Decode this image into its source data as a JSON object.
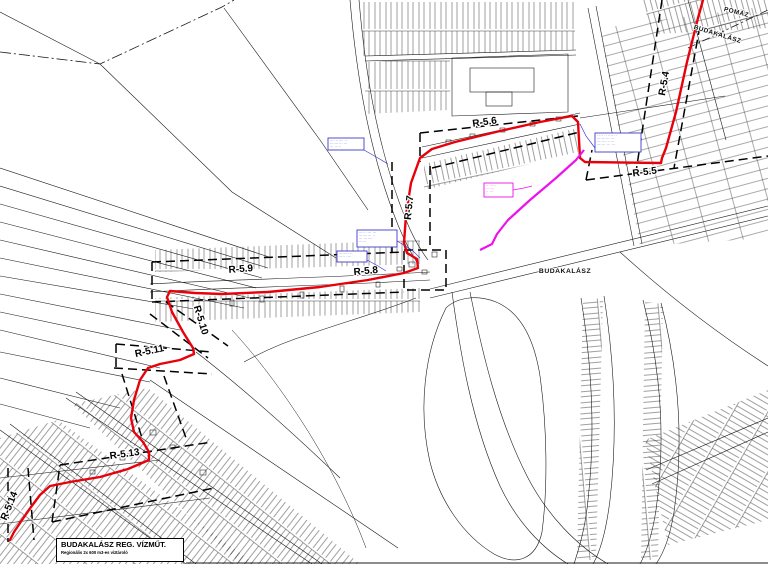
{
  "map": {
    "colors": {
      "route": "#e8000a",
      "magenta": "#ec12ec",
      "callout_blue": "#3c3ccc",
      "ink": "#000000"
    },
    "place_labels": [
      {
        "text": "POMÁZ",
        "x": 736,
        "y": 14,
        "rot": 14,
        "size": 6.4
      },
      {
        "text": "BUDAKALÁSZ",
        "x": 717,
        "y": 36,
        "rot": 17,
        "size": 6.4
      },
      {
        "text": "BUDAKALÁSZ",
        "x": 565,
        "y": 273,
        "rot": 0,
        "size": 6.8
      }
    ],
    "sheet_labels": [
      {
        "text": "R-5.4",
        "x": 667,
        "y": 84,
        "rot": -80
      },
      {
        "text": "R-5.5",
        "x": 645,
        "y": 175,
        "rot": -7
      },
      {
        "text": "R-5.6",
        "x": 485,
        "y": 125,
        "rot": -8
      },
      {
        "text": "R-5.7",
        "x": 412,
        "y": 208,
        "rot": -84
      },
      {
        "text": "R-5.8",
        "x": 366,
        "y": 274,
        "rot": -5
      },
      {
        "text": "R-5.9",
        "x": 241,
        "y": 272,
        "rot": -4
      },
      {
        "text": "R-5.10",
        "x": 198,
        "y": 321,
        "rot": 73
      },
      {
        "text": "R-5.11",
        "x": 150,
        "y": 354,
        "rot": -12
      },
      {
        "text": "R-5.13",
        "x": 125,
        "y": 457,
        "rot": -8
      },
      {
        "text": "R-5.14",
        "x": 12,
        "y": 507,
        "rot": -68
      }
    ],
    "routes": {
      "red_main": [
        [
          703,
          0
        ],
        [
          698,
          18
        ],
        [
          687,
          62
        ],
        [
          676,
          112
        ],
        [
          666,
          148
        ],
        [
          662,
          158
        ],
        [
          661,
          163
        ],
        [
          585,
          162
        ],
        [
          580,
          158
        ],
        [
          578,
          122
        ],
        [
          572,
          116
        ],
        [
          540,
          122
        ],
        [
          500,
          131
        ],
        [
          455,
          142
        ],
        [
          432,
          149
        ],
        [
          420,
          158
        ],
        [
          411,
          183
        ],
        [
          406,
          215
        ],
        [
          404,
          243
        ],
        [
          407,
          253
        ],
        [
          417,
          259
        ],
        [
          418,
          268
        ],
        [
          404,
          273
        ],
        [
          368,
          280
        ],
        [
          320,
          287
        ],
        [
          268,
          292
        ],
        [
          222,
          294
        ],
        [
          195,
          293
        ],
        [
          170,
          291
        ],
        [
          167,
          297
        ],
        [
          172,
          312
        ],
        [
          183,
          332
        ],
        [
          193,
          348
        ],
        [
          194,
          354
        ],
        [
          180,
          360
        ],
        [
          160,
          364
        ],
        [
          148,
          368
        ],
        [
          140,
          380
        ],
        [
          134,
          400
        ],
        [
          131,
          418
        ],
        [
          134,
          432
        ],
        [
          143,
          442
        ],
        [
          149,
          452
        ],
        [
          149,
          460
        ],
        [
          128,
          469
        ],
        [
          100,
          477
        ],
        [
          70,
          482
        ],
        [
          50,
          486
        ],
        [
          40,
          495
        ],
        [
          31,
          507
        ],
        [
          22,
          520
        ],
        [
          14,
          532
        ],
        [
          10,
          540
        ]
      ],
      "magenta": [
        [
          584,
          150
        ],
        [
          576,
          160
        ],
        [
          556,
          178
        ],
        [
          530,
          200
        ],
        [
          508,
          220
        ],
        [
          497,
          234
        ],
        [
          492,
          244
        ],
        [
          480,
          250
        ]
      ]
    },
    "callouts": {
      "blue": [
        {
          "x": 328,
          "y": 138,
          "w": 36,
          "h": 12,
          "lines": [
            "···· ······ ··",
            "········· ····",
            "··· ·····"
          ],
          "leader": [
            [
              364,
              150
            ],
            [
              378,
              158
            ],
            [
              388,
              164
            ]
          ]
        },
        {
          "x": 357,
          "y": 230,
          "w": 40,
          "h": 17,
          "lines": [
            "····· ···· ···",
            "·········· ··",
            "··· ·······",
            "······"
          ],
          "leader": [
            [
              397,
              241
            ],
            [
              412,
              250
            ],
            [
              420,
              258
            ]
          ]
        },
        {
          "x": 337,
          "y": 251,
          "w": 30,
          "h": 11,
          "lines": [
            "········ ··",
            "····· ····"
          ],
          "leader": [
            [
              367,
              260
            ],
            [
              378,
              266
            ],
            [
              386,
              271
            ]
          ]
        },
        {
          "x": 595,
          "y": 133,
          "w": 46,
          "h": 19,
          "lines": [
            "· ··· ·· ···· ··",
            "·········· ···",
            "········ ·····",
            "······· ··· ···"
          ],
          "leader": [
            [
              595,
              148
            ],
            [
              586,
              136
            ],
            [
              580,
              124
            ]
          ]
        }
      ],
      "magenta": {
        "x": 484,
        "y": 183,
        "w": 29,
        "h": 14,
        "lines": [
          "·· ·····",
          "·······",
          "·· ···"
        ],
        "leader": [
          [
            513,
            190
          ],
          [
            524,
            188
          ],
          [
            532,
            186
          ]
        ]
      }
    },
    "title_block": {
      "line1": "BUDAKALÁSZ REG. VÍZMŰT.",
      "line2": "Regionális 2x 600 m3-es víztároló"
    }
  }
}
